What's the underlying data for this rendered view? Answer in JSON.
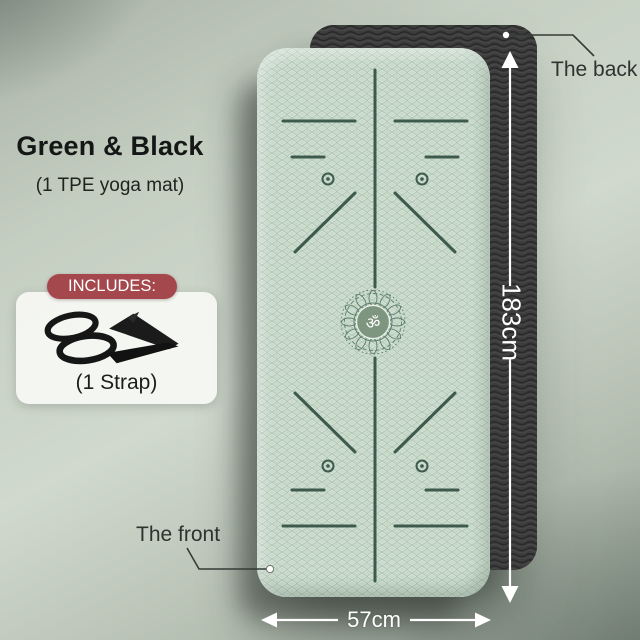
{
  "product": {
    "title": "Green & Black",
    "subtitle": "(1 TPE yoga mat)",
    "includes_label": "INCLUDES:",
    "includes_item": "(1 Strap)"
  },
  "annotations": {
    "back_label": "The back",
    "front_label": "The front",
    "length": "183cm",
    "width": "57cm"
  },
  "mat": {
    "om_symbol": "ॐ"
  },
  "colors": {
    "badge_maroon": "#a5484d",
    "mat_green": "#c9dacb",
    "mat_black": "#3e3e3e",
    "marking_green": "#3d5a4d",
    "background_sage": "#c4cec1",
    "annotation_white": "#ffffff",
    "annotation_dark": "#2d332e"
  }
}
